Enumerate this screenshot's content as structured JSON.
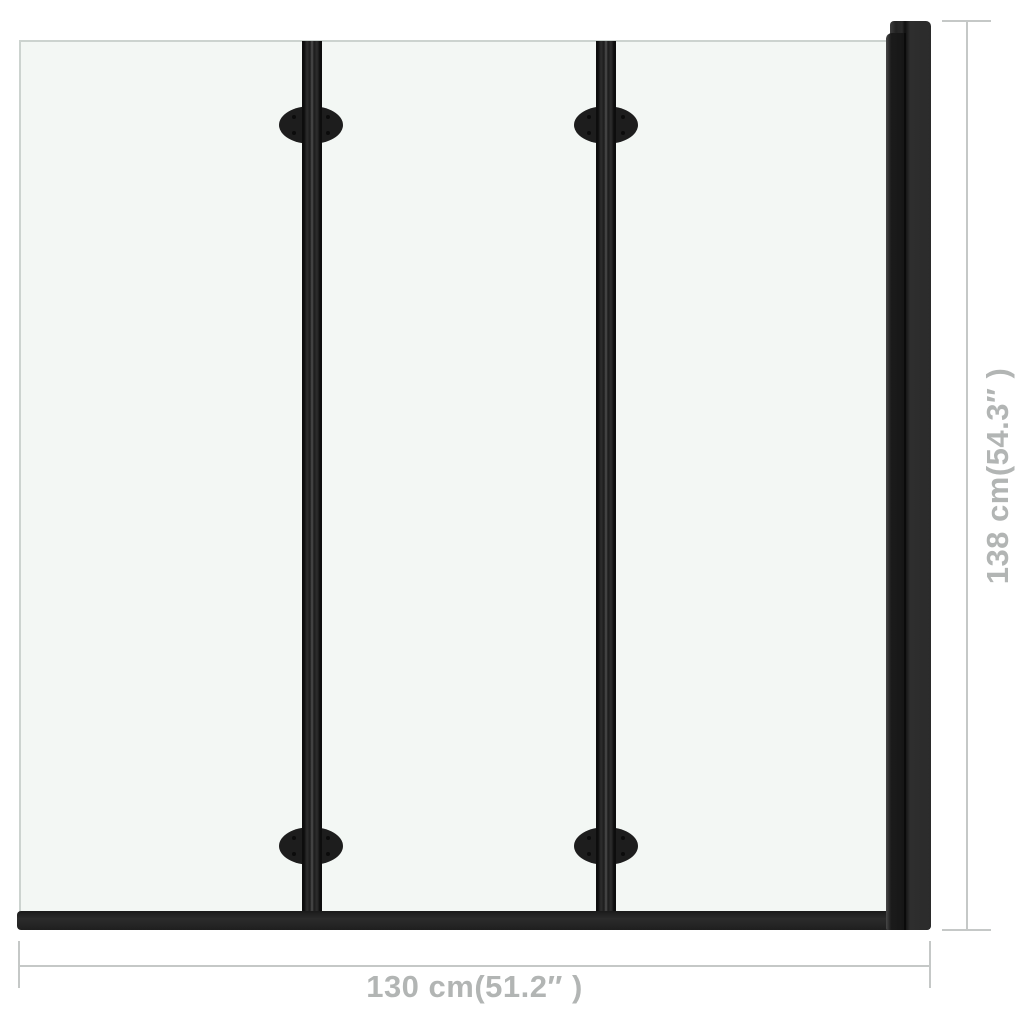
{
  "scene": {
    "background_color": "#ffffff",
    "description": "Dimension diagram of a 3-panel folding shower bath screen with black frame"
  },
  "screen": {
    "panel_count": 3,
    "fold_bar_count": 2,
    "hinge_count": 4,
    "frame_color": "#1f1f1f",
    "glass_color": "#f3f7f4",
    "glass_edge_color": "#ccd3cf"
  },
  "dimensions": {
    "line_color": "#c5c8c7",
    "text_color": "#b2b5b4",
    "width": {
      "label": "130 cm(51.2″ )"
    },
    "height": {
      "label": "138 cm(54.3″ )"
    }
  }
}
